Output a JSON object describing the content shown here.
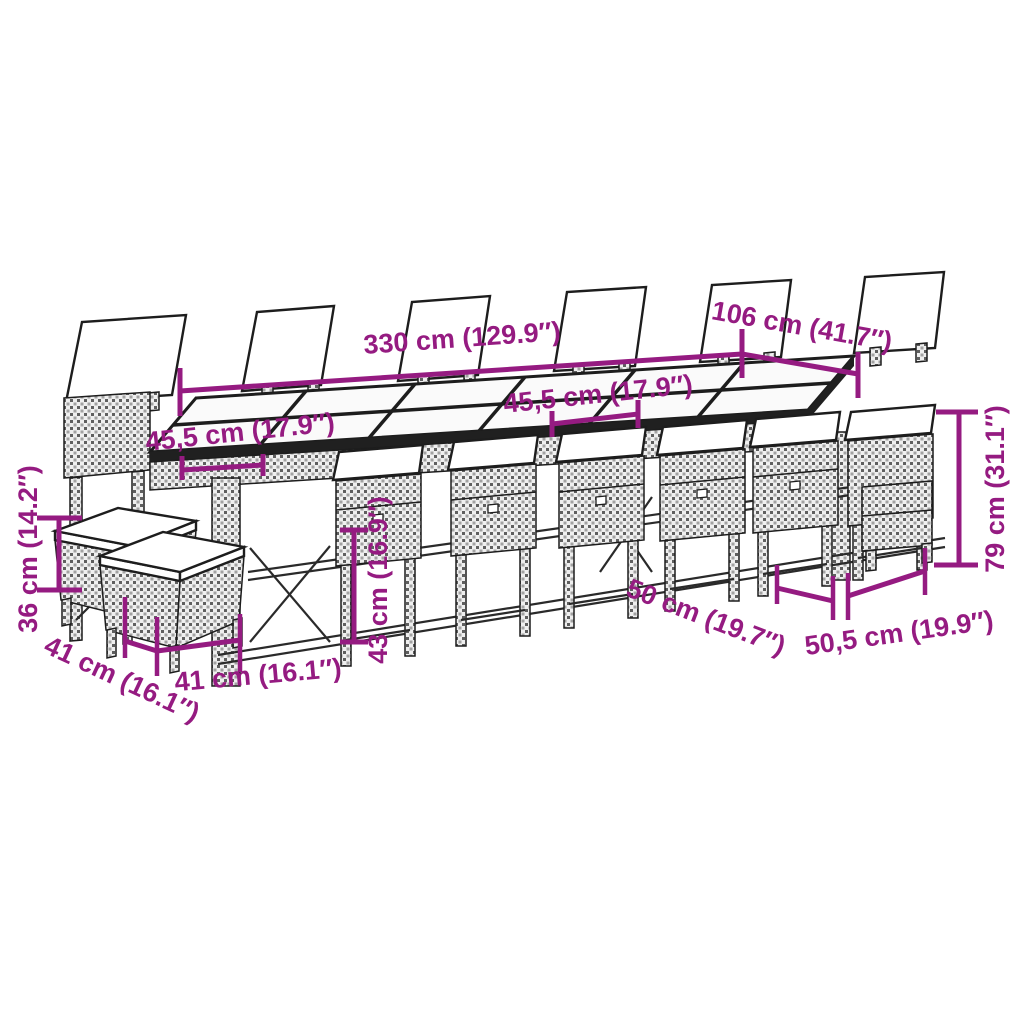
{
  "colors": {
    "accent": "#951b81",
    "line": "#1d1d1d",
    "background": "#ffffff"
  },
  "diagram": {
    "type": "furniture-dimension-diagram",
    "scene": {
      "far_chair_backrests": 6,
      "near_chairs": 6,
      "end_chairs": 2,
      "stools": 2,
      "table_glass_panels": 12
    },
    "dimensions": {
      "table_length": "330 cm (129.9″)",
      "table_width": "106 cm (41.7″)",
      "backrest_width_left": "45,5 cm (17.9″)",
      "backrest_width_middle": "45,5 cm (17.9″)",
      "stool_height": "36 cm (14.2″)",
      "stool_depth": "41 cm (16.1″)",
      "stool_width": "41 cm (16.1″)",
      "chair_seat_height": "43 cm (16.9″)",
      "chair_depth": "50 cm (19.7″)",
      "chair_width": "50,5 cm (19.9″)",
      "chair_height": "79 cm (31.1″)"
    }
  }
}
